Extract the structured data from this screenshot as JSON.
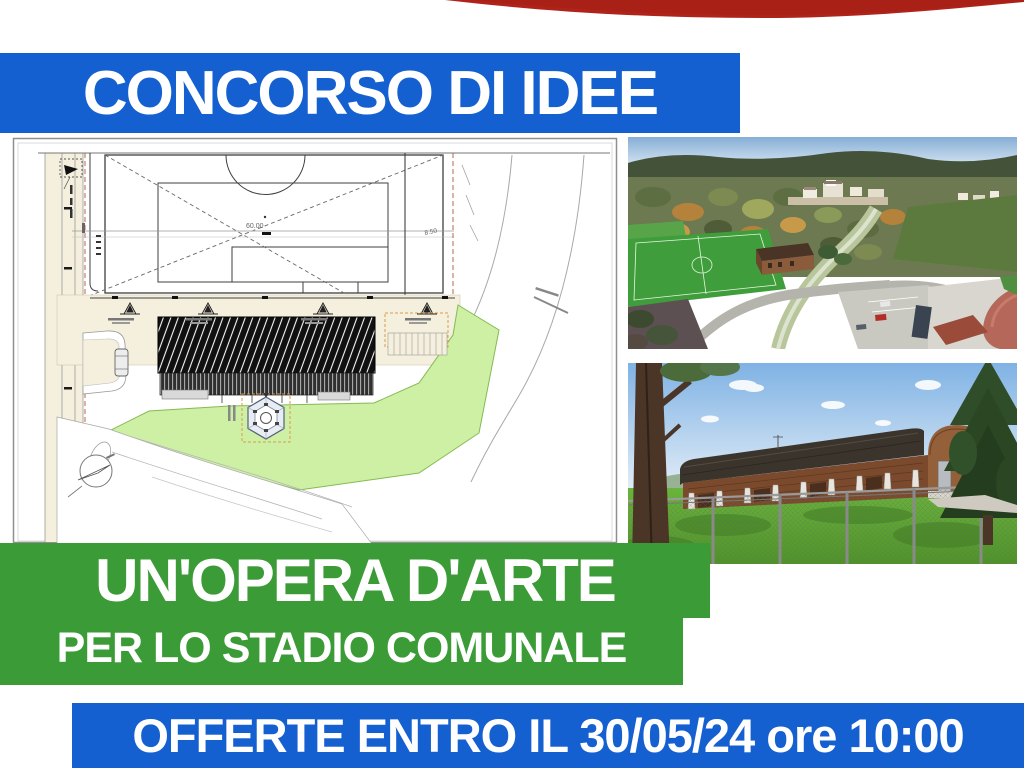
{
  "poster": {
    "title": "CONCORSO DI IDEE",
    "headline_line1": "UN'OPERA D'ARTE",
    "headline_line2": "PER LO STADIO COMUNALE",
    "deadline": "OFFERTE ENTRO IL 30/05/24 ore 10:00"
  },
  "site_plan": {
    "dimension_label_1": "60.00",
    "dimension_label_2": "8.50"
  },
  "colors": {
    "banner_blue": "#1560d0",
    "banner_green": "#3b9b36",
    "swoosh_red": "#b0231a",
    "text_white": "#ffffff",
    "plan_beige": "#f5f0dd",
    "plan_lawn_green": "#cdf0a4"
  }
}
